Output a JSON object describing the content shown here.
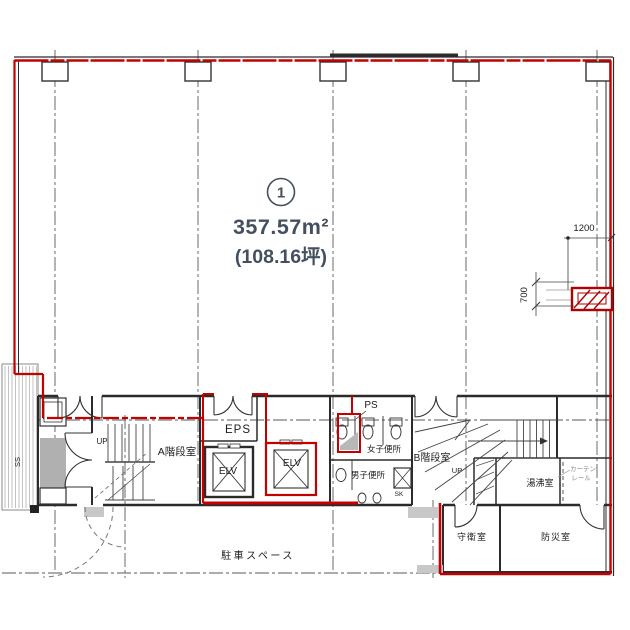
{
  "unit": {
    "number": "1",
    "area_sqm": "357.57m²",
    "area_tsubo": "(108.16坪)"
  },
  "rooms": {
    "stair_a": "A階段室",
    "up_a": "UP",
    "eps": "EPS",
    "elv_left": "ELV",
    "elv_right": "ELV",
    "ps": "PS",
    "womens_toilet": "女子便所",
    "mens_toilet": "男子便所",
    "sk": "SK",
    "stair_b": "B階段室",
    "up_b": "UP",
    "hot_water_room": "湯沸室",
    "curtain_rail_line1": "カーテン",
    "curtain_rail_line2": "レール",
    "guard_room": "守衛室",
    "disaster_room": "防災室",
    "parking_space": "駐車スペース",
    "ss": "SS"
  },
  "dimensions": {
    "width_note": "1200",
    "height_note": "700"
  },
  "colors": {
    "boundary_red": "#c40000",
    "wall_black": "#2b2b2b",
    "label_slate": "#44505f",
    "grid_gray": "#5a5a5a",
    "fill_gray": "#b5b5b5"
  }
}
